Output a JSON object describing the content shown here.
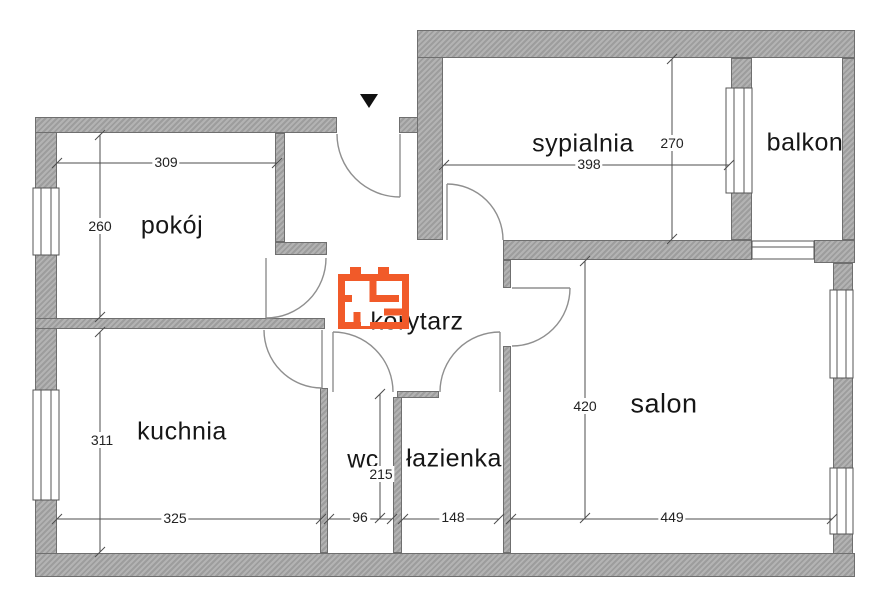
{
  "floorplan": {
    "rooms": {
      "pokoj": {
        "label": "pokój",
        "width": "309",
        "height": "260"
      },
      "sypialnia": {
        "label": "sypialnia",
        "width": "398",
        "height": "270"
      },
      "balkon": {
        "label": "balkon"
      },
      "kuchnia": {
        "label": "kuchnia",
        "width": "325",
        "height": "311"
      },
      "korytarz": {
        "label": "korytarz"
      },
      "wc": {
        "label": "wc",
        "width": "96",
        "height": "215"
      },
      "lazienka": {
        "label": "łazienka",
        "width": "148"
      },
      "salon": {
        "label": "salon",
        "width": "449",
        "height": "420"
      }
    },
    "icons": {
      "entrance_marker": "down-triangle",
      "brand_logo": "orange-floorplan-logo"
    },
    "colors": {
      "wall_gray": "#a8a8a8",
      "logo_orange": "#f15a29",
      "dimension_line": "#555555",
      "door_arc": "#8f8f8f"
    }
  }
}
